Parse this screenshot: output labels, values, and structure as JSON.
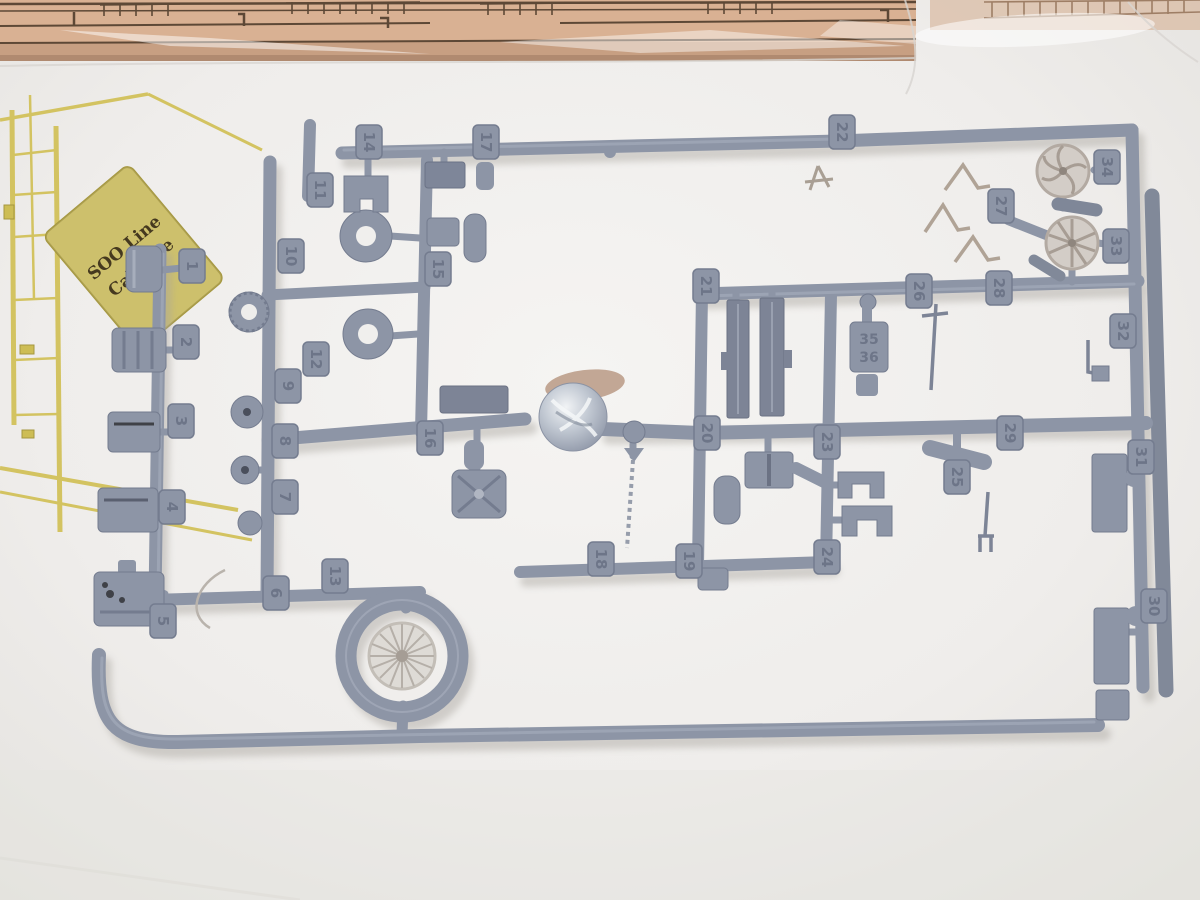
{
  "meta": {
    "description": "Photo of an HO scale model kit: gray plastic parts sprue with numbered tags, brass etched fret, and bagged laser-cut wood parts",
    "subject": "SOO Line Caboose model kit contents"
  },
  "colors": {
    "background": "#ebe9e6",
    "sprue_main": "#8d95a6",
    "sprue_dark": "#747c8f",
    "sprue_light": "#a7aebc",
    "tag_number": "#6d7588",
    "brass": "#d3c361",
    "brass_dark": "#a5973f",
    "wood": "#d9b193",
    "wood_line": "#5d4836",
    "pale_part": "#d3cdc7"
  },
  "fret": {
    "label_line1": "SOO Line",
    "label_line2": "Caboose"
  },
  "sprue": {
    "molded_text_line1": "35",
    "molded_text_line2": "36",
    "tags": [
      {
        "n": "1",
        "x": 192,
        "y": 266
      },
      {
        "n": "2",
        "x": 186,
        "y": 342
      },
      {
        "n": "3",
        "x": 181,
        "y": 421
      },
      {
        "n": "4",
        "x": 172,
        "y": 507
      },
      {
        "n": "5",
        "x": 163,
        "y": 621
      },
      {
        "n": "6",
        "x": 276,
        "y": 593
      },
      {
        "n": "7",
        "x": 285,
        "y": 497
      },
      {
        "n": "8",
        "x": 285,
        "y": 441
      },
      {
        "n": "9",
        "x": 288,
        "y": 386
      },
      {
        "n": "10",
        "x": 291,
        "y": 256
      },
      {
        "n": "11",
        "x": 320,
        "y": 190
      },
      {
        "n": "12",
        "x": 316,
        "y": 359
      },
      {
        "n": "13",
        "x": 335,
        "y": 576
      },
      {
        "n": "14",
        "x": 369,
        "y": 142
      },
      {
        "n": "15",
        "x": 438,
        "y": 269
      },
      {
        "n": "16",
        "x": 430,
        "y": 438
      },
      {
        "n": "17",
        "x": 486,
        "y": 142
      },
      {
        "n": "18",
        "x": 601,
        "y": 559
      },
      {
        "n": "19",
        "x": 689,
        "y": 561
      },
      {
        "n": "20",
        "x": 707,
        "y": 433
      },
      {
        "n": "21",
        "x": 706,
        "y": 286
      },
      {
        "n": "22",
        "x": 842,
        "y": 132
      },
      {
        "n": "23",
        "x": 827,
        "y": 442
      },
      {
        "n": "24",
        "x": 827,
        "y": 557
      },
      {
        "n": "25",
        "x": 957,
        "y": 477
      },
      {
        "n": "26",
        "x": 919,
        "y": 291
      },
      {
        "n": "27",
        "x": 1001,
        "y": 206
      },
      {
        "n": "28",
        "x": 999,
        "y": 288
      },
      {
        "n": "29",
        "x": 1010,
        "y": 433
      },
      {
        "n": "30",
        "x": 1154,
        "y": 606
      },
      {
        "n": "31",
        "x": 1141,
        "y": 457
      },
      {
        "n": "32",
        "x": 1123,
        "y": 331
      },
      {
        "n": "33",
        "x": 1116,
        "y": 246
      },
      {
        "n": "34",
        "x": 1107,
        "y": 167
      }
    ]
  }
}
